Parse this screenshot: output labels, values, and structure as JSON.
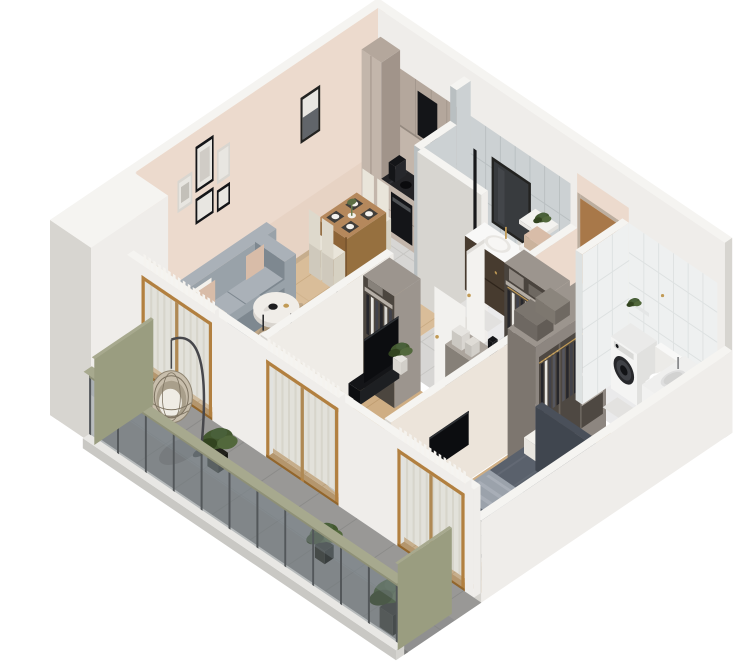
{
  "meta": {
    "type": "isometric-3d-apartment-floor-plan",
    "background": "#ffffff",
    "canvas": {
      "width": 750,
      "height": 671
    }
  },
  "palette": {
    "wallTop": "#f5f4f1",
    "wallWhite": "#efedea",
    "wallDark": "#d7d5d0",
    "beige": "#ecdacd",
    "beigeDark": "#e2cabb",
    "tileGrayW": "#ccd1d3",
    "tileGrayD": "#b9bfc1",
    "tileWhiteW": "#eef0f0",
    "tileWhiteD": "#dde1e1",
    "woodA": "#d9bd99",
    "woodALine": "#c9ab83",
    "woodB": "#cfae84",
    "woodBLine": "#bf9c70",
    "tileFloor": "#d7d6d4",
    "tileLine": "#c7c6c3",
    "marble": "#eaeaeb",
    "stone": "#909090",
    "stoneLight": "#a19f9c",
    "stoneLine": "#7e7e7c",
    "curb": "#e8e7e4",
    "glass": "#6e7a81",
    "post": "#53575a",
    "olive": "#8e9077",
    "oliveLight": "#a7a98e",
    "olivePanel": "#9a9d80",
    "sofa": "#99a2a9",
    "sofaDark": "#7e8890",
    "sofaLight": "#aab1b8",
    "blush": "#d8bca8",
    "white": "#f3f1ec",
    "rug": "#d6d1ca",
    "rugDark": "#c4bdb5",
    "wood": "#b5885c",
    "woodDark": "#96703f",
    "cream": "#e9e5da",
    "creamDark": "#d6d1c2",
    "taupe": "#b4a79c",
    "taupeLight": "#c3b6ab",
    "taupeDark": "#a1948a",
    "counter": "#232326",
    "black": "#141518",
    "panel": "#0c0d10",
    "bedDuvet": "#5a616c",
    "bedDark": "#4a505a",
    "bedLight": "#9ba2ab",
    "headboard": "#40464f",
    "doorBrown": "#a87849",
    "doorDark": "#8a5f35",
    "frame": "#b28040",
    "frameDark": "#92662c",
    "curtain": "#f1ece3",
    "curtainDim": "#e3ddd1",
    "green": "#43582f",
    "greenDark": "#32431f",
    "washer": "#f4f4f3",
    "gold": "#c19a55",
    "grayCab": "#9c958e",
    "grayCabD": "#868078",
    "clothesDark": "#26262b",
    "clothesMid": "#41424b",
    "vanity": "#473b2f",
    "mirror": "#232321",
    "porcelain": "#f8f8f7",
    "artLight": "#e8e6e1",
    "shadow": "#2a2724"
  },
  "scene": {
    "sections": [
      "back-walls",
      "balcony-block",
      "floors",
      "kitchen",
      "bathroom-top",
      "hallway-entrance",
      "living-room",
      "dining-area",
      "partition-living",
      "bedroom-1",
      "corridor-storage",
      "partition-master",
      "master-bedroom",
      "bathroom-right",
      "se-wall",
      "sw-wall-windows",
      "balcony",
      "railing"
    ],
    "rooms": [
      {
        "id": "living-room",
        "objects": [
          "gray-sofa",
          "blush-pillows",
          "area-rug",
          "round-coffee-tables",
          "globe-lamp",
          "floor-lamp",
          "wall-art-frames",
          "tv-panel"
        ]
      },
      {
        "id": "dining-area",
        "objects": [
          "wood-dining-table",
          "four-chairs",
          "placemats",
          "flower-vase"
        ]
      },
      {
        "id": "kitchen",
        "objects": [
          "taupe-cabinets",
          "black-marble-counter",
          "induction-hob",
          "oven",
          "range-hood",
          "sink",
          "coffee-maker"
        ]
      },
      {
        "id": "bathroom-top",
        "objects": [
          "dark-vanity",
          "basin",
          "framed-mirror",
          "shelf-tower",
          "towels",
          "plant"
        ]
      },
      {
        "id": "hallway-entrance",
        "objects": [
          "brown-entrance-door",
          "storage-cabinet",
          "books",
          "open-closet",
          "hanging-clothes"
        ]
      },
      {
        "id": "bedroom-1",
        "objects": [
          "round-rug",
          "green-lounge-seat",
          "open-closet",
          "tv",
          "curtains",
          "plant"
        ]
      },
      {
        "id": "master-bedroom",
        "objects": [
          "double-bed",
          "dark-duvet",
          "white-pillows",
          "throw-blanket",
          "headboard",
          "open-wardrobe",
          "hanging-clothes",
          "wall-tv"
        ]
      },
      {
        "id": "bathroom-right",
        "objects": [
          "washing-machine",
          "toilet",
          "counter-basin",
          "shelf-niche",
          "white-tiles"
        ]
      },
      {
        "id": "balcony",
        "objects": [
          "hanging-egg-chair",
          "potted-plants",
          "stone-floor",
          "glass-railing",
          "olive-privacy-panels"
        ]
      }
    ]
  }
}
